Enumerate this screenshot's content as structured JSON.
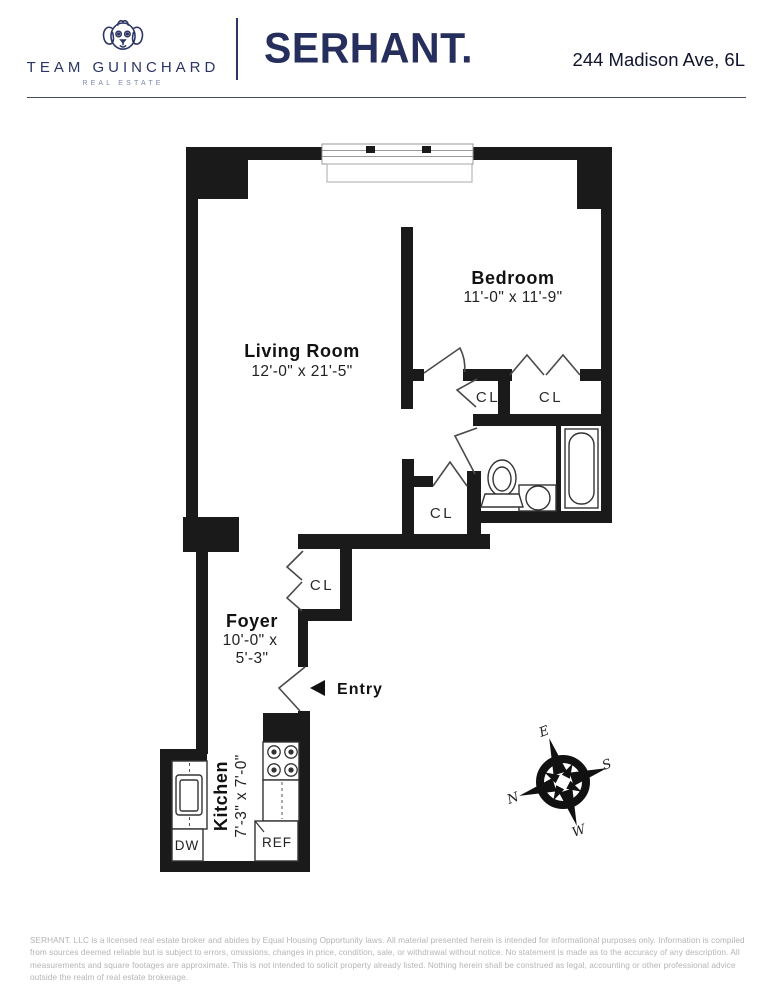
{
  "header": {
    "team_name": "TEAM GUINCHARD",
    "team_subtitle": "REAL ESTATE",
    "brand": "SERHANT.",
    "address": "244 Madison Ave, 6L",
    "brand_color": "#252e5c"
  },
  "floorplan": {
    "wall_color": "#1a1a1a",
    "rooms": {
      "living_room": {
        "name": "Living Room",
        "dims": "12'-0\" x 21'-5\""
      },
      "bedroom": {
        "name": "Bedroom",
        "dims": "11'-0\" x 11'-9\""
      },
      "foyer": {
        "name": "Foyer",
        "dims_line1": "10'-0\" x",
        "dims_line2": "5'-3\""
      },
      "kitchen": {
        "name": "Kitchen",
        "dims": "7'-3\" x 7'-0\""
      }
    },
    "closets": [
      "CL",
      "CL",
      "CL",
      "CL"
    ],
    "entry_label": "Entry",
    "appliances": {
      "dishwasher": "DW",
      "refrigerator": "REF"
    },
    "compass": {
      "n": "N",
      "e": "E",
      "s": "S",
      "w": "W"
    }
  },
  "footer": {
    "disclaimer": "SERHANT. LLC is a licensed real estate broker and abides by Equal Housing Opportunity laws. All material presented herein is intended for informational purposes only. Information is compiled from sources deemed  reliable but is subject to errors, omissions, changes in price, condition, sale, or withdrawal without notice. No statement is made as to the accuracy of any description. All measurements and square footages are approximate. This is not intended to solicit property already listed. Nothing herein shall be construed as legal, accounting or other professional advice outside the realm of real estate brokerage."
  }
}
